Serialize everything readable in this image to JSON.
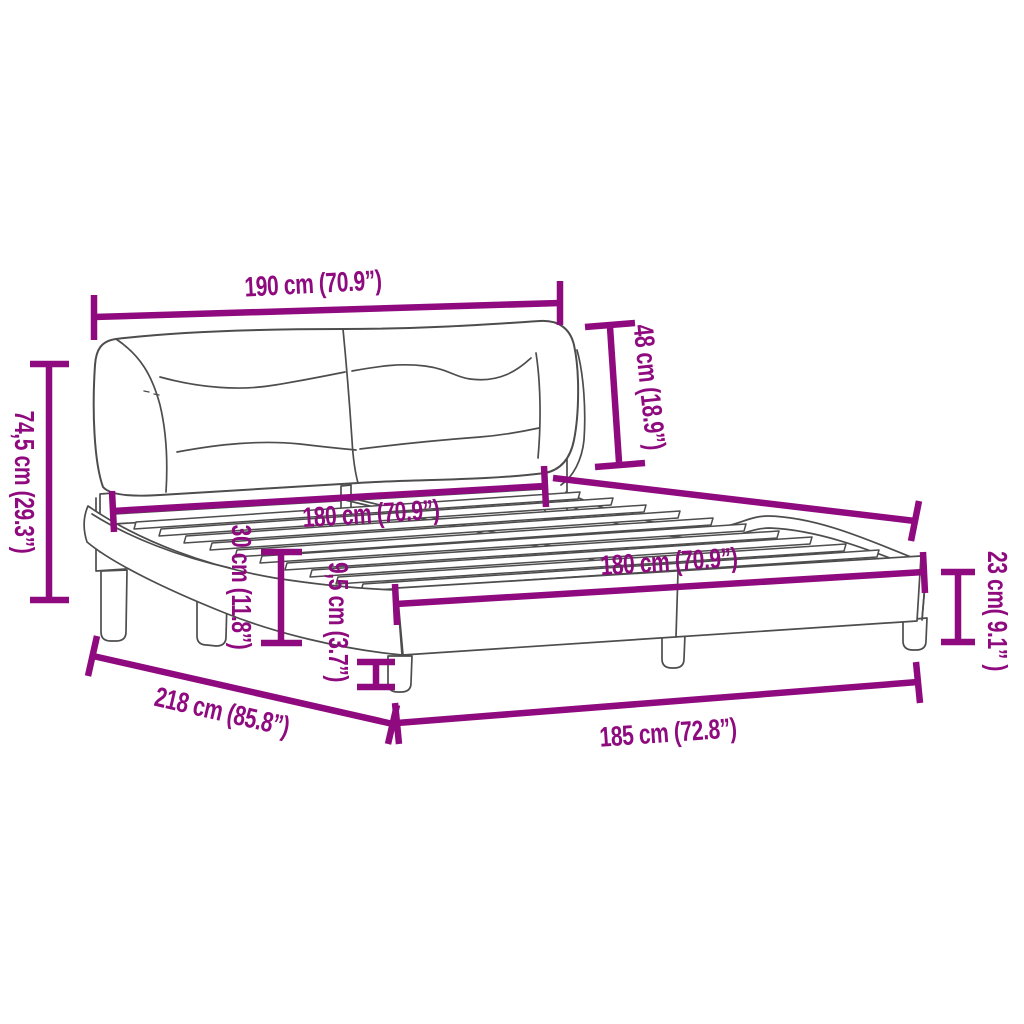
{
  "diagram": {
    "type": "bed-frame-dimension-diagram",
    "background_color": "#ffffff",
    "dimension_color": "#8E0A7E",
    "line_art_color": "#4d4d4d"
  },
  "labels": {
    "headboard_width": "190 cm (70.9”)",
    "headboard_height": "48 cm (18.9”)",
    "total_height": "74,5 cm (29.3”)",
    "slat_width_head": "180 cm (70.9”)",
    "side_rail_height": "30 cm (11.8”)",
    "ground_clearance": "9,5 cm (3.7”)",
    "slat_width_foot": "180 cm (70.9”)",
    "frame_side_height": "23 cm( 9.1” )",
    "total_length": "218 cm (85.8”)",
    "total_width": "185 cm (72.8”)"
  }
}
